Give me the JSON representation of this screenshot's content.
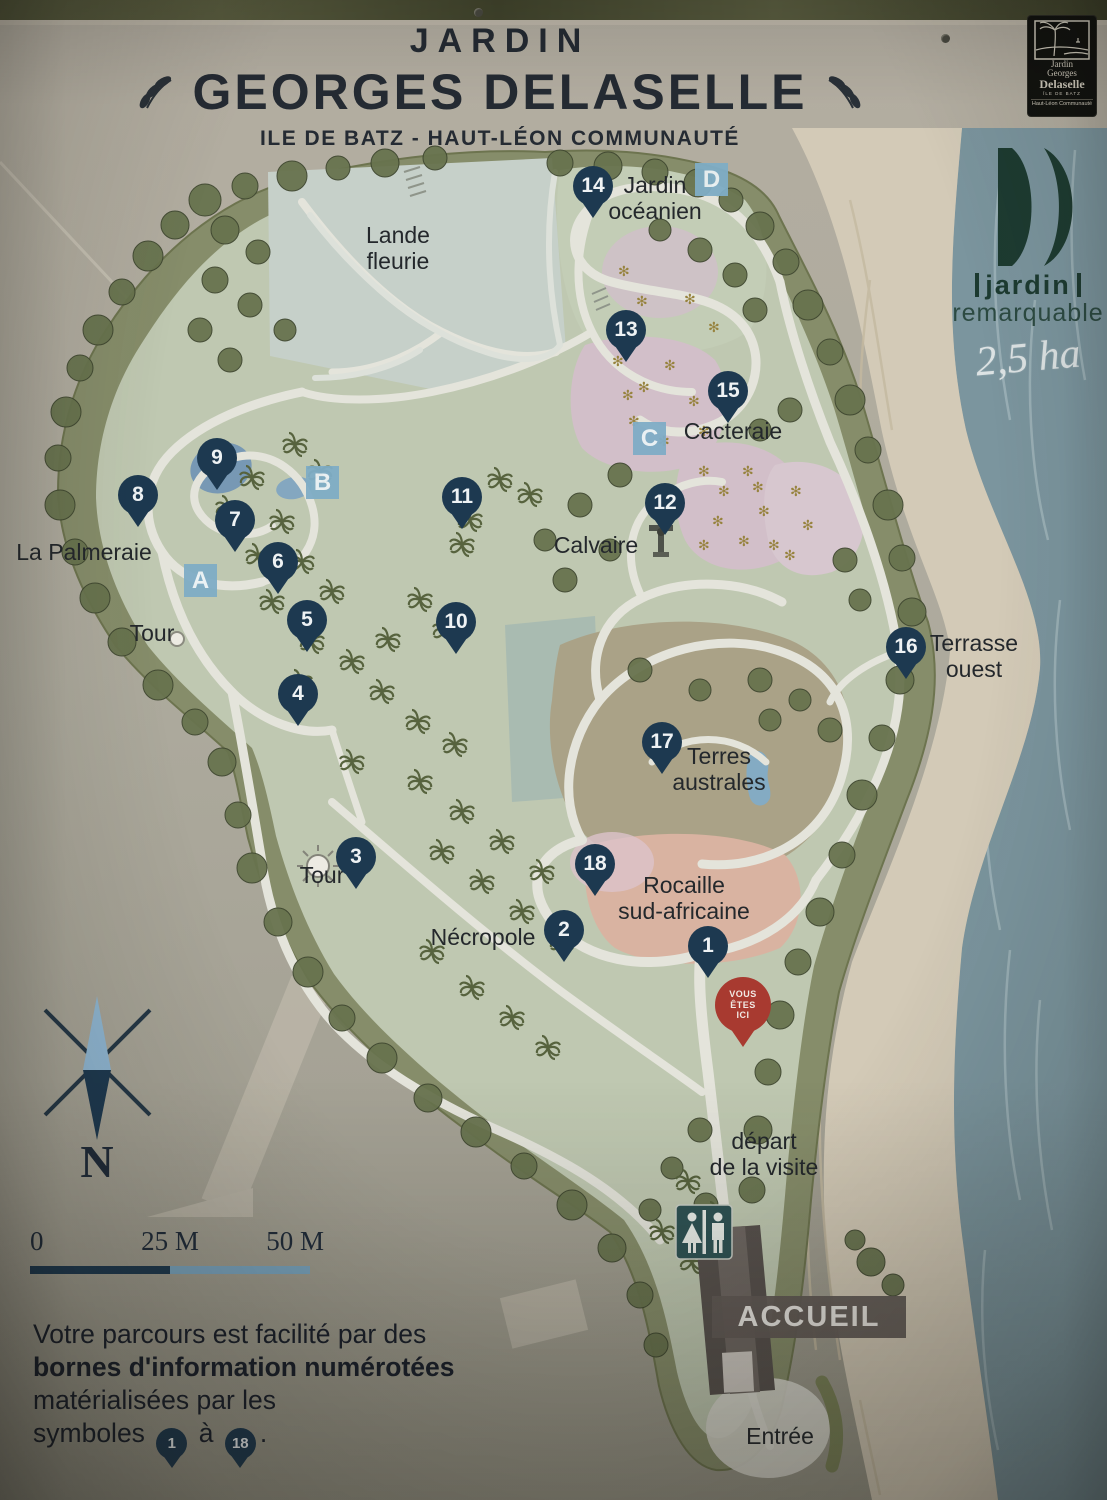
{
  "sign": {
    "title_top": "JARDIN",
    "title_main": "GEORGES DELASELLE",
    "subtitle": "ILE DE BATZ - HAUT-LÉON COMMUNAUTÉ"
  },
  "corner_logo": {
    "line1": "Jardin",
    "line2": "Georges",
    "line3": "Delaselle",
    "line4": "ÎLE DE BATZ",
    "line5": "Haut-Léon Communauté"
  },
  "badge": {
    "word1": "jardin",
    "word2": "remarquable",
    "area_note": "2,5 ha"
  },
  "compass": {
    "north_label": "N"
  },
  "scale_bar": {
    "start": "0",
    "mid": "25 M",
    "end": "50 M"
  },
  "legend": {
    "line1": "Votre parcours est facilité par des",
    "line2_bold": "bornes d'information numérotées",
    "line3": "matérialisées par les",
    "line4_prefix": "symboles",
    "pin_from": "1",
    "line4_conj": "à",
    "pin_to": "18",
    "line4_end": "."
  },
  "map": {
    "accueil_label": "ACCUEIL",
    "you_are_here": {
      "lines": [
        "VOUS",
        "ÊTES",
        "ICI"
      ],
      "x": 743,
      "y": 1005
    },
    "markers": [
      {
        "num": "1",
        "x": 708,
        "y": 946
      },
      {
        "num": "2",
        "x": 564,
        "y": 930
      },
      {
        "num": "3",
        "x": 356,
        "y": 857
      },
      {
        "num": "4",
        "x": 298,
        "y": 694
      },
      {
        "num": "5",
        "x": 307,
        "y": 620
      },
      {
        "num": "6",
        "x": 278,
        "y": 562
      },
      {
        "num": "7",
        "x": 235,
        "y": 520
      },
      {
        "num": "8",
        "x": 138,
        "y": 495
      },
      {
        "num": "9",
        "x": 217,
        "y": 458
      },
      {
        "num": "10",
        "x": 456,
        "y": 622
      },
      {
        "num": "11",
        "x": 462,
        "y": 497
      },
      {
        "num": "12",
        "x": 665,
        "y": 503
      },
      {
        "num": "13",
        "x": 626,
        "y": 330
      },
      {
        "num": "14",
        "x": 593,
        "y": 186
      },
      {
        "num": "15",
        "x": 728,
        "y": 391
      },
      {
        "num": "16",
        "x": 906,
        "y": 647
      },
      {
        "num": "17",
        "x": 662,
        "y": 742
      },
      {
        "num": "18",
        "x": 595,
        "y": 864
      }
    ],
    "letter_stations": [
      {
        "letter": "A",
        "x": 201,
        "y": 581
      },
      {
        "letter": "B",
        "x": 323,
        "y": 483
      },
      {
        "letter": "C",
        "x": 650,
        "y": 439
      },
      {
        "letter": "D",
        "x": 712,
        "y": 180
      }
    ],
    "labels": [
      {
        "id": "lande-fleurie",
        "lines": [
          "Lande",
          "fleurie"
        ],
        "x": 398,
        "y": 222
      },
      {
        "id": "jardin-oceanien",
        "lines": [
          "Jardin",
          "océanien"
        ],
        "x": 655,
        "y": 172
      },
      {
        "id": "cacteraie",
        "lines": [
          "Cacteraie"
        ],
        "x": 733,
        "y": 418
      },
      {
        "id": "calvaire",
        "lines": [
          "Calvaire"
        ],
        "x": 596,
        "y": 532
      },
      {
        "id": "la-palmeraie",
        "lines": [
          "La Palmeraie"
        ],
        "x": 84,
        "y": 539
      },
      {
        "id": "tour-nord",
        "lines": [
          "Tour"
        ],
        "x": 152,
        "y": 620
      },
      {
        "id": "terrasse-ouest",
        "lines": [
          "Terrasse",
          "ouest"
        ],
        "x": 974,
        "y": 630
      },
      {
        "id": "terres-australes",
        "lines": [
          "Terres",
          "australes"
        ],
        "x": 719,
        "y": 743
      },
      {
        "id": "rocaille",
        "lines": [
          "Rocaille",
          "sud-africaine"
        ],
        "x": 684,
        "y": 872
      },
      {
        "id": "necropole",
        "lines": [
          "Nécropole"
        ],
        "x": 483,
        "y": 924
      },
      {
        "id": "tour-sud",
        "lines": [
          "Tour"
        ],
        "x": 322,
        "y": 862
      },
      {
        "id": "depart-visite",
        "lines": [
          "départ",
          "de la visite"
        ],
        "x": 764,
        "y": 1128
      },
      {
        "id": "entree",
        "lines": [
          "Entrée"
        ],
        "x": 780,
        "y": 1423
      }
    ]
  },
  "colors": {
    "pin_navy": "#1d3950",
    "station_blue": "#7fadc6",
    "you_are_here_red": "#a83a30",
    "sea": "#7b959e",
    "sand": "#d3cab7",
    "garden_ring_olive": "#868d6a",
    "garden_inner_green": "#bfc8b1",
    "lande_pale": "#c6d0c9",
    "cacteraie_pink": "#d2bfc9",
    "rocaille_salmon": "#d9b3a1",
    "terres_tan": "#aaa287",
    "pond_blue": "#7798b4",
    "path_white": "#e4e4db",
    "cactus_gold": "#97833e",
    "badge_green": "#1d3b31"
  }
}
